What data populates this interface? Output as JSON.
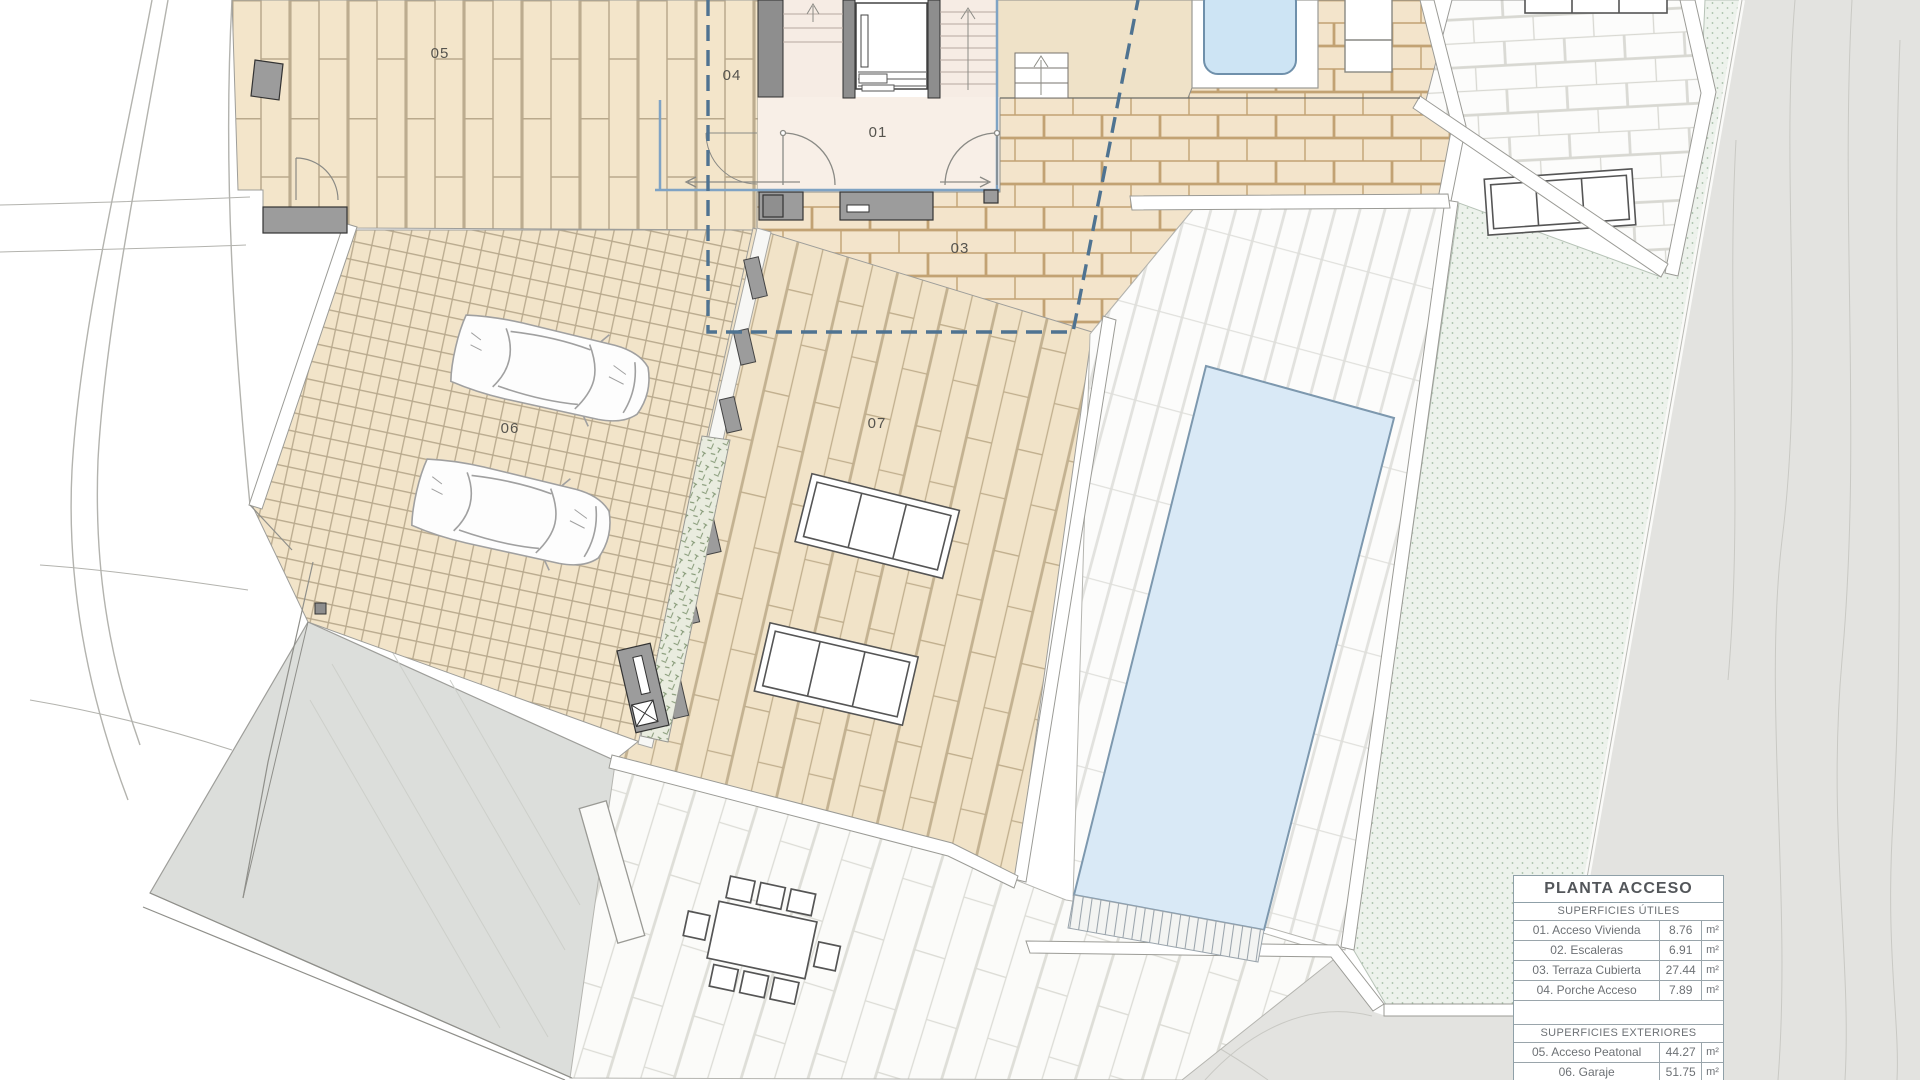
{
  "plan": {
    "labels": {
      "l01": "01",
      "l03": "03",
      "l04": "04",
      "l05": "05",
      "l06": "06",
      "l07": "07"
    }
  },
  "legend": {
    "title": "PLANTA ACCESO",
    "sections": [
      {
        "header": "SUPERFICIES ÚTILES",
        "rows": [
          {
            "name": "01. Acceso Vivienda",
            "value": "8.76",
            "unit": "m²"
          },
          {
            "name": "02. Escaleras",
            "value": "6.91",
            "unit": "m²"
          },
          {
            "name": "03. Terraza Cubierta",
            "value": "27.44",
            "unit": "m²"
          },
          {
            "name": "04. Porche Acceso",
            "value": "7.89",
            "unit": "m²"
          }
        ]
      },
      {
        "header": "SUPERFICIES EXTERIORES",
        "rows": [
          {
            "name": "05. Acceso Peatonal",
            "value": "44.27",
            "unit": "m²"
          },
          {
            "name": "06. Garaje",
            "value": "51.75",
            "unit": "m²"
          }
        ]
      }
    ]
  },
  "colors": {
    "paving_beige": "#f3e5ca",
    "brick_joint": "#c2a273",
    "pool_water": "#d9e9f6",
    "jacuzzi_water": "#cde4f4",
    "roof_dash": "#4f7391",
    "glazing_blue": "#7fa3c4",
    "garden_green": "#edf2ec",
    "terrain_gray": "#e3e3e0",
    "wall_gray": "#9c9c9c"
  }
}
